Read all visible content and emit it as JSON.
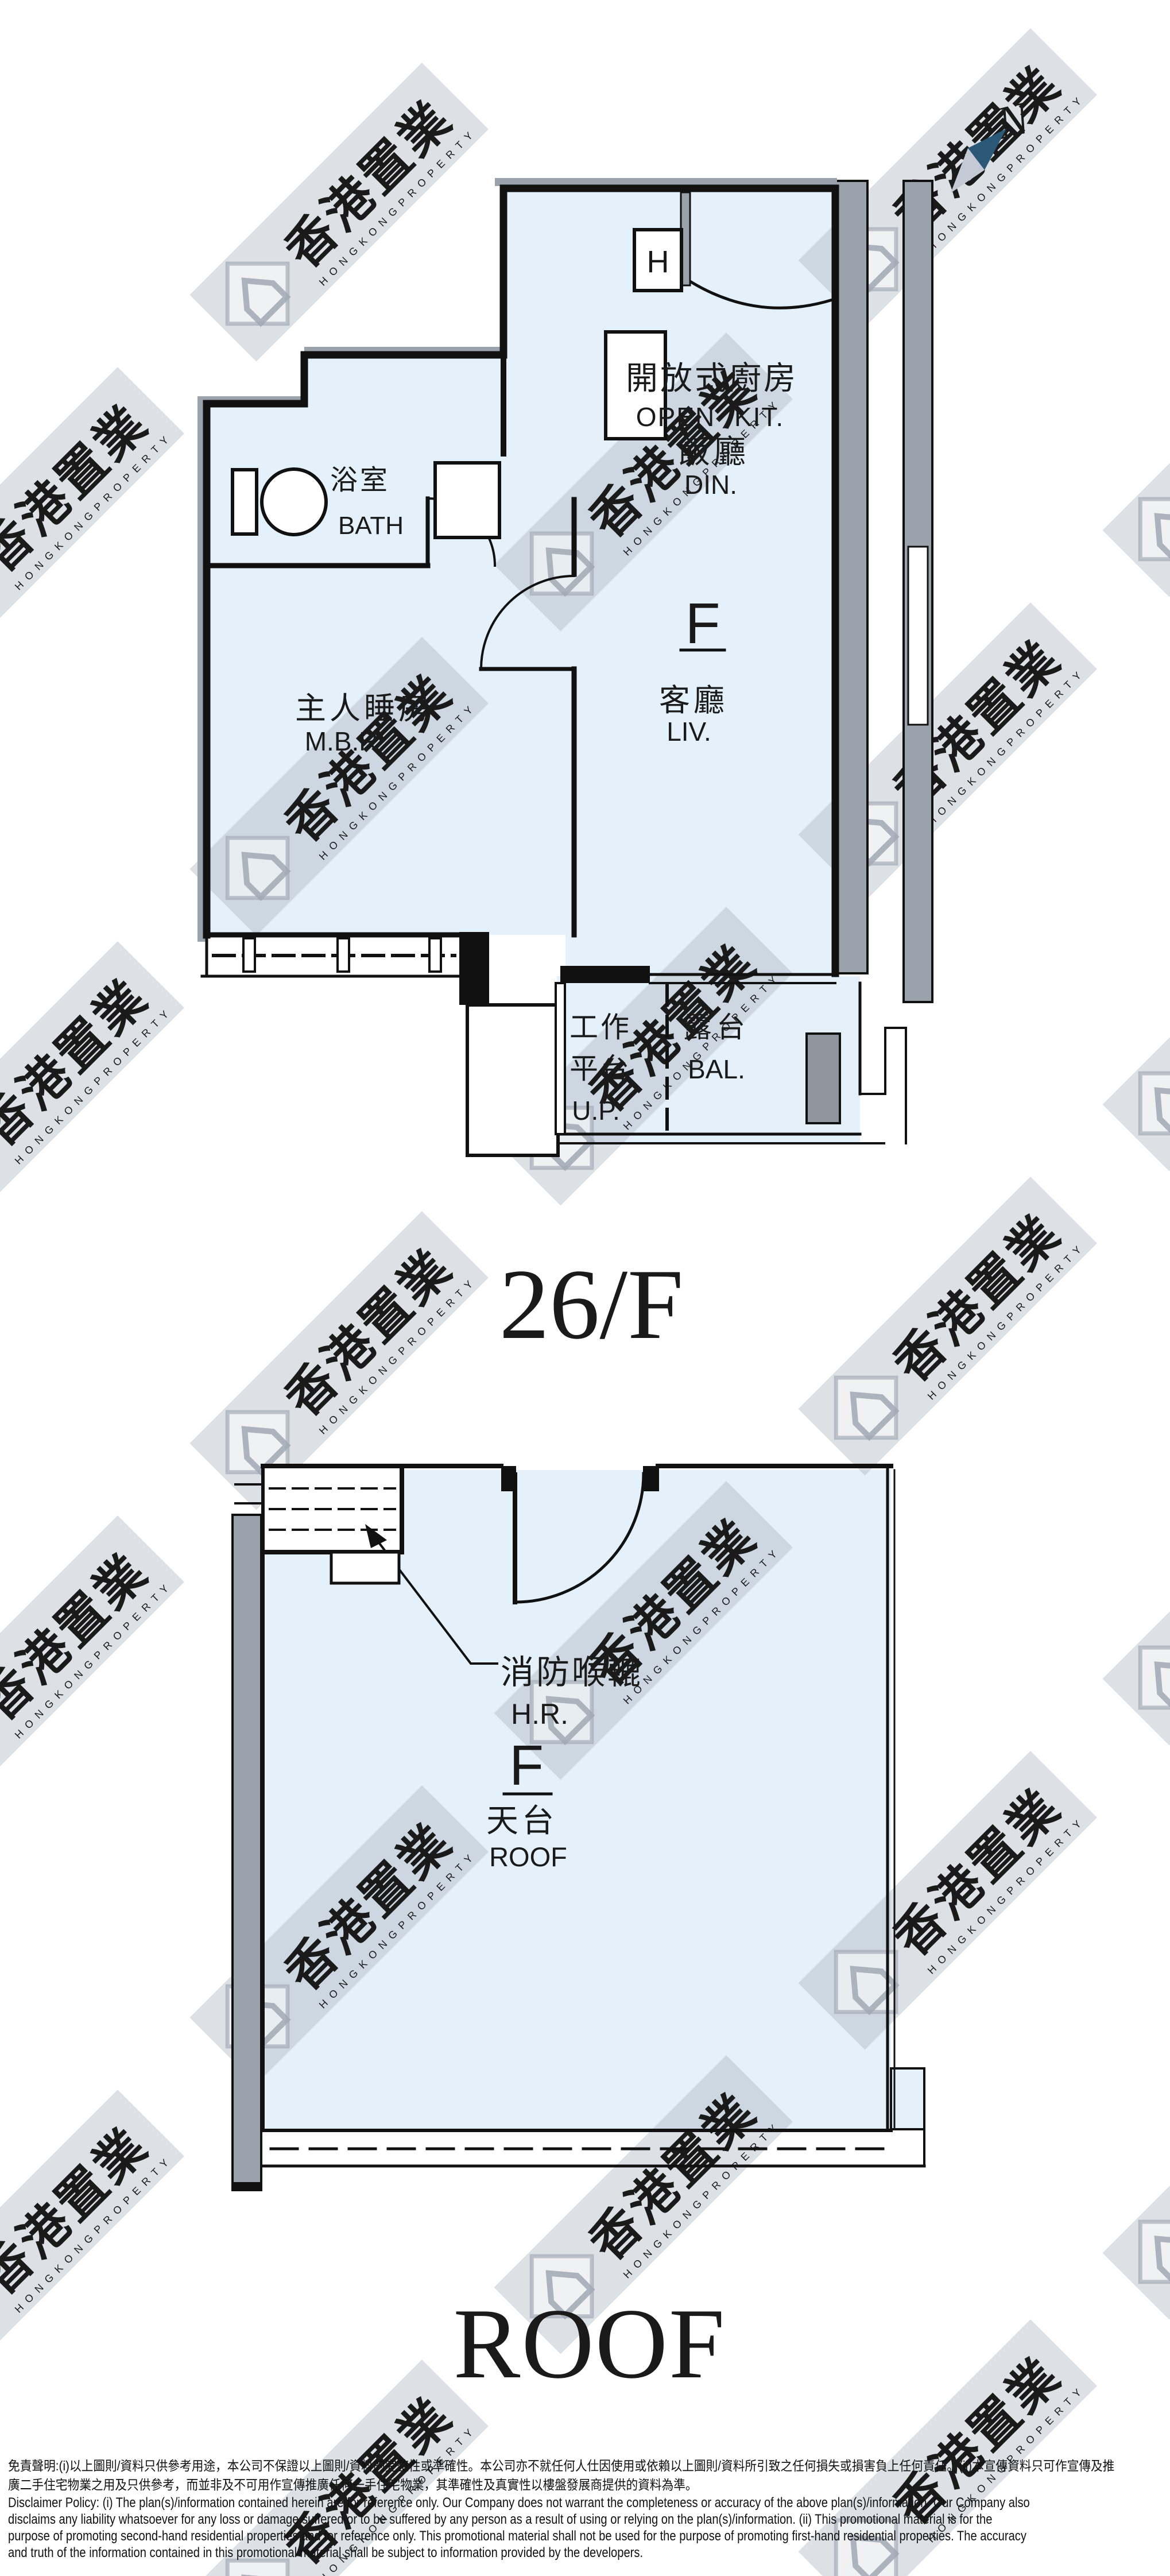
{
  "compass": {
    "north_label": "N",
    "needle_dark": "#2b5877",
    "needle_light": "#c4cad5"
  },
  "colors": {
    "floor_blue": "#e4f1fa",
    "wall_black": "#111111",
    "wall_gray": "#9aa2ab",
    "watermark_gray": "rgba(169,177,190,0.40)"
  },
  "floor_26f": {
    "title": "26/F",
    "heater_label": "H",
    "unit_label": "F",
    "rooms": {
      "kitchen_cjk": "開放式廚房",
      "kitchen_en": "OPEN KIT.",
      "dining_cjk": "飯廳",
      "dining_en": "DIN.",
      "living_cjk": "客廳",
      "living_en": "LIV.",
      "bath_cjk": "浴室",
      "bath_en": "BATH",
      "mbr_cjk": "主人睡房",
      "mbr_en": "M.B.R.",
      "up_cjk_line1": "工作",
      "up_cjk_line2": "平台",
      "up_en": "U.P.",
      "bal_cjk": "露台",
      "bal_en": "BAL."
    }
  },
  "floor_roof": {
    "title": "ROOF",
    "unit_label": "F",
    "hose_reel_cjk": "消防喉轆",
    "hose_reel_en": "H.R.",
    "roof_cjk": "天台",
    "roof_en": "ROOF"
  },
  "watermark": {
    "cjk": "香港置業",
    "en": "H O N G   K O N G   P R O P E R T Y"
  },
  "disclaimer": {
    "lines": [
      "免責聲明:(i)以上圖則/資料只供參考用途，本公司不保證以上圖則/資料的完整性或準確性。本公司亦不就任何人仕因使用或依賴以上圖則/資料所引致之任何損失或損害負上任何責任。(ii)本宣傳資料只可作宣傳及推",
      "廣二手住宅物業之用及只供參考，而並非及不可用作宣傳推廣任何一手住宅物業，其準確性及真實性以樓盤發展商提供的資料為準。",
      "Disclaimer Policy: (i) The plan(s)/information contained herein are for reference only. Our Company does not warrant the completeness or accuracy of the above plan(s)/information. Our Company also",
      "disclaims any liability whatsoever for any loss or damage suffered or to be suffered by any person as a result of using or relying on the plan(s)/information. (ii) This promotional material is for the",
      "purpose of promoting second-hand residential properties and for reference only. This promotional material shall not be used for the purpose of promoting first-hand residential properties. The accuracy",
      "and truth of the information contained in this promotional material shall be subject to information provided by the developers."
    ]
  }
}
